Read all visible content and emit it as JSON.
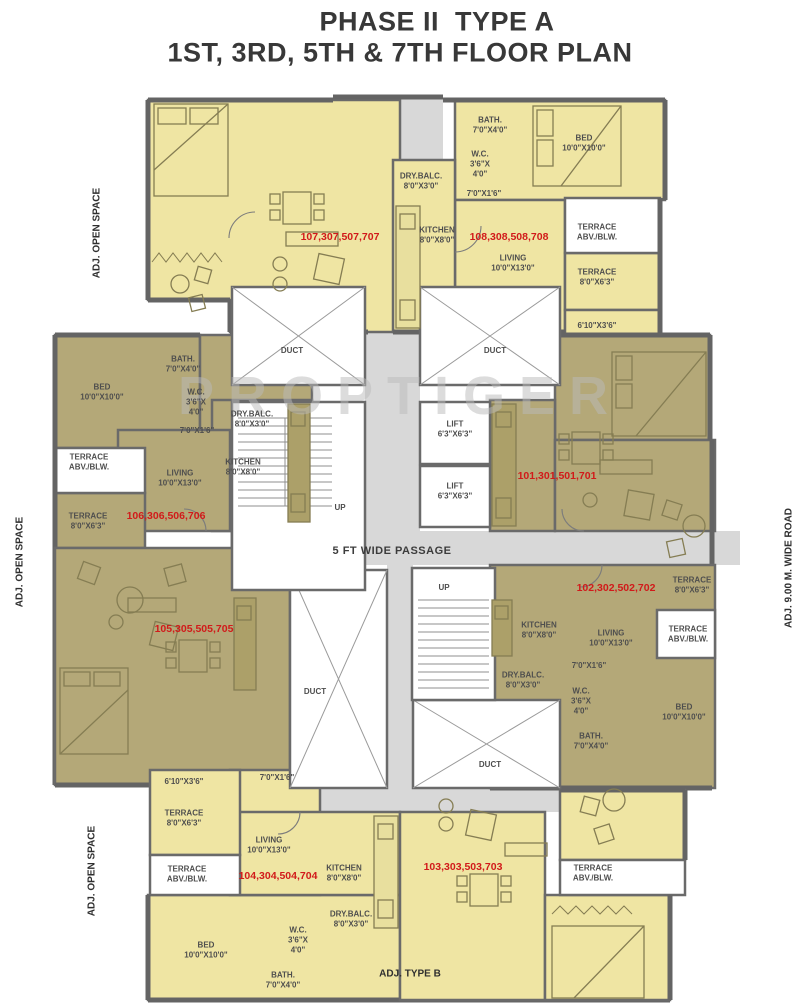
{
  "title": {
    "line1": "PHASE II  TYPE A",
    "line2": "1ST, 3RD, 5TH & 7TH FLOOR PLAN"
  },
  "watermark": "PROPTIGER",
  "surroundings": {
    "left_top": "ADJ. OPEN SPACE",
    "left_middle": "ADJ. OPEN SPACE",
    "left_bottom": "ADJ. OPEN SPACE",
    "right": "ADJ. 9.00 M. WIDE ROAD",
    "bottom_adjacent": "ADJ. TYPE B"
  },
  "core": {
    "passage": "5 FT WIDE PASSAGE",
    "duct": "DUCT",
    "up": "UP",
    "lift": {
      "name": "LIFT",
      "dims": "6'3\"X6'3\""
    }
  },
  "colors": {
    "unit_light": "#efe5a3",
    "unit_dark": "#b4a878",
    "wall": "#6a6a6a",
    "floor_gray": "#d8d8d8",
    "unit_number_red": "#d11a1a"
  },
  "units": [
    {
      "number": "107,307,507,707",
      "rooms": {}
    },
    {
      "number": "108,308,508,708",
      "rooms": {
        "bath": {
          "name": "BATH.",
          "dims": "7'0\"X4'0\""
        },
        "wc": {
          "name": "W.C.",
          "dims": "3'6\"X 4'0\""
        },
        "bed": {
          "name": "BED",
          "dims": "10'0\"X10'0\""
        },
        "drybalc": {
          "name": "DRY.BALC.",
          "dims": "8'0\"X3'0\""
        },
        "passage7": {
          "dims": "7'0\"X1'6\""
        },
        "kitchen": {
          "name": "KITCHEN",
          "dims": "8'0\"X8'0\""
        },
        "living": {
          "name": "LIVING",
          "dims": "10'0\"X13'0\""
        },
        "terrace_abv": {
          "name": "TERRACE",
          "dims": "ABV./BLW."
        },
        "terrace": {
          "name": "TERRACE",
          "dims": "8'0\"X6'3\""
        },
        "strip610": {
          "dims": "6'10\"X3'6\""
        }
      }
    },
    {
      "number": "101,301,501,701",
      "rooms": {}
    },
    {
      "number": "102,302,502,702",
      "rooms": {
        "bath": {
          "name": "BATH.",
          "dims": "7'0\"X4'0\""
        },
        "wc": {
          "name": "W.C.",
          "dims": "3'6\"X 4'0\""
        },
        "bed": {
          "name": "BED",
          "dims": "10'0\"X10'0\""
        },
        "drybalc": {
          "name": "DRY.BALC.",
          "dims": "8'0\"X3'0\""
        },
        "passage7": {
          "dims": "7'0\"X1'6\""
        },
        "kitchen": {
          "name": "KITCHEN",
          "dims": "8'0\"X8'0\""
        },
        "living": {
          "name": "LIVING",
          "dims": "10'0\"X13'0\""
        },
        "terrace_abv": {
          "name": "TERRACE",
          "dims": "ABV./BLW."
        },
        "terrace": {
          "name": "TERRACE",
          "dims": "8'0\"X6'3\""
        }
      }
    },
    {
      "number": "106,306,506,706",
      "rooms": {
        "bath": {
          "name": "BATH.",
          "dims": "7'0\"X4'0\""
        },
        "wc": {
          "name": "W.C.",
          "dims": "3'6\"X 4'0\""
        },
        "bed": {
          "name": "BED",
          "dims": "10'0\"X10'0\""
        },
        "drybalc": {
          "name": "DRY.BALC.",
          "dims": "8'0\"X3'0\""
        },
        "passage7": {
          "dims": "7'0\"X1'6\""
        },
        "kitchen": {
          "name": "KITCHEN",
          "dims": "8'0\"X8'0\""
        },
        "living": {
          "name": "LIVING",
          "dims": "10'0\"X13'0\""
        },
        "terrace_abv": {
          "name": "TERRACE",
          "dims": "ABV./BLW."
        },
        "terrace": {
          "name": "TERRACE",
          "dims": "8'0\"X6'3\""
        }
      }
    },
    {
      "number": "105,305,505,705",
      "rooms": {}
    },
    {
      "number": "104,304,504,704",
      "rooms": {
        "bath": {
          "name": "BATH.",
          "dims": "7'0\"X4'0\""
        },
        "wc": {
          "name": "W.C.",
          "dims": "3'6\"X 4'0\""
        },
        "bed": {
          "name": "BED",
          "dims": "10'0\"X10'0\""
        },
        "drybalc": {
          "name": "DRY.BALC.",
          "dims": "8'0\"X3'0\""
        },
        "passage7": {
          "dims": "7'0\"X1'6\""
        },
        "kitchen": {
          "name": "KITCHEN",
          "dims": "8'0\"X8'0\""
        },
        "living": {
          "name": "LIVING",
          "dims": "10'0\"X13'0\""
        },
        "terrace_abv": {
          "name": "TERRACE",
          "dims": "ABV./BLW."
        },
        "terrace": {
          "name": "TERRACE",
          "dims": "8'0\"X6'3\""
        },
        "strip610": {
          "dims": "6'10\"X3'6\""
        }
      }
    },
    {
      "number": "103,303,503,703",
      "rooms": {
        "terrace_abv": {
          "name": "TERRACE",
          "dims": "ABV./BLW."
        }
      }
    }
  ]
}
